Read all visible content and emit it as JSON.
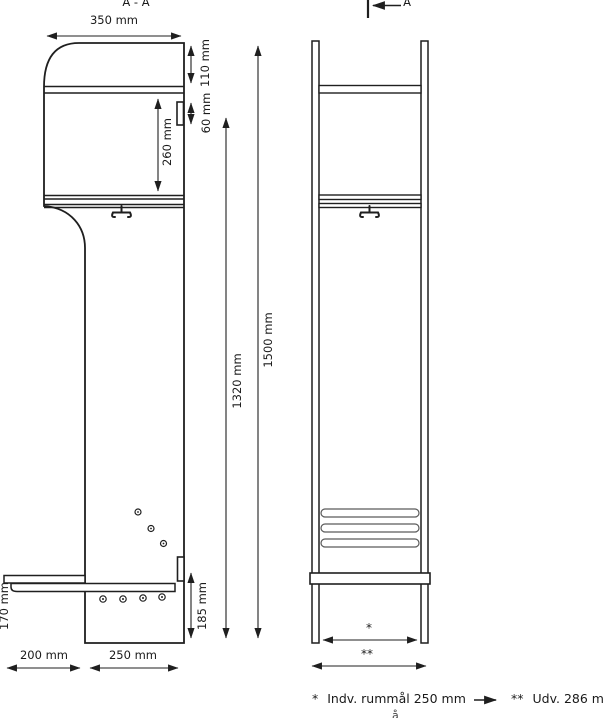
{
  "page": {
    "section_title": "A - A",
    "cut_marker": "A"
  },
  "dimensions": {
    "top_width": "350 mm",
    "top_height": "110 mm",
    "hinge_height": "60 mm",
    "compartment_height": "260 mm",
    "body_height": "1320 mm",
    "total_height": "1500 mm",
    "seat_to_bottom": "185 mm",
    "bench_depth": "170 mm",
    "bench_overhang": "200 mm",
    "panel_depth": "250 mm",
    "inner_width_marker": "*",
    "outer_width_marker": "**"
  },
  "footnotes": {
    "inner_marker": "*",
    "inner_text": "Indv. rummål 250 mm",
    "outer_marker": "**",
    "outer_text": "Udv. 286 mm",
    "cutoff_fragment": "å"
  }
}
